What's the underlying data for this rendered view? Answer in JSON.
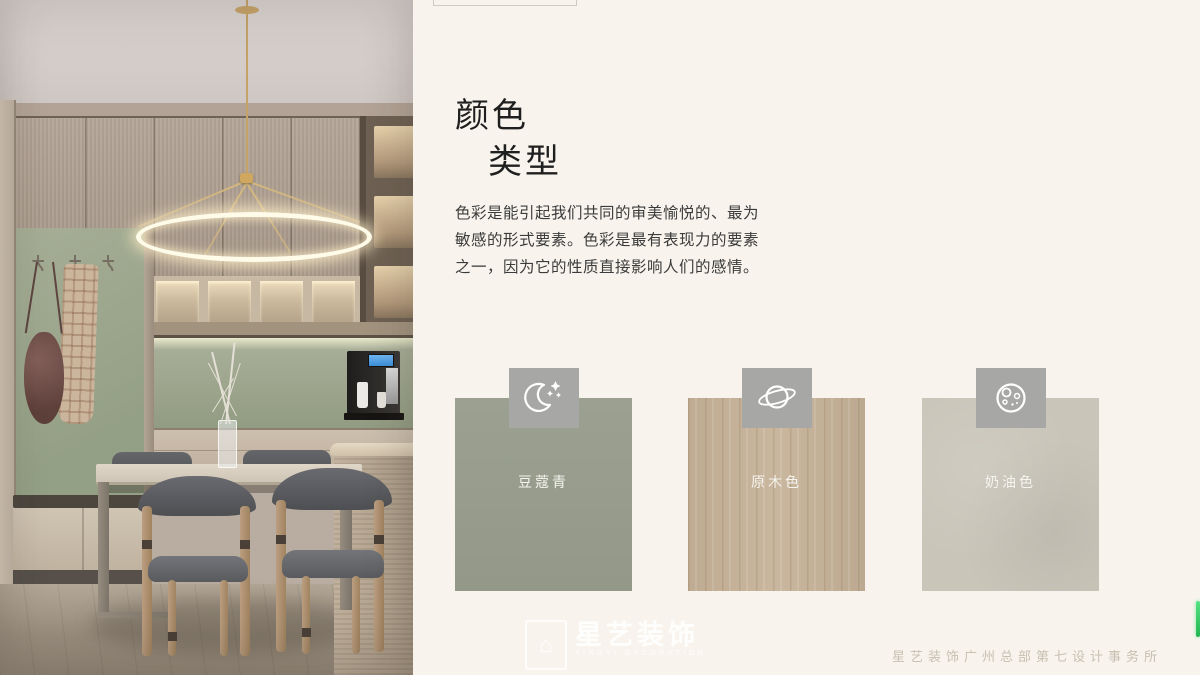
{
  "header": {
    "title_line1": "颜色",
    "title_line2": "类型"
  },
  "intro": {
    "line1": "色彩是能引起我们共同的审美愉悦的、最为",
    "line2": "敏感的形式要素。色彩是最有表现力的要素",
    "line3": "之一，因为它的性质直接影响人们的感情。"
  },
  "swatches": {
    "icon_box_color": "#a7a7a5",
    "items": [
      {
        "label": "豆蔻青",
        "color": "#989d8d",
        "icon": "moon-stars-icon"
      },
      {
        "label": "原木色",
        "color": "#c6b298",
        "icon": "planet-icon"
      },
      {
        "label": "奶油色",
        "color": "#c9c5b9",
        "icon": "cookie-icon"
      }
    ]
  },
  "watermark": {
    "logo_glyph": "⌂",
    "name": "星艺装饰",
    "subtitle": "XINGYI DECORATION"
  },
  "footer": {
    "company": "星艺装饰广州总部第七设计事务所"
  },
  "accent": {
    "green_bar": "#2fd05f",
    "panel_background": "#f8f4ed"
  }
}
